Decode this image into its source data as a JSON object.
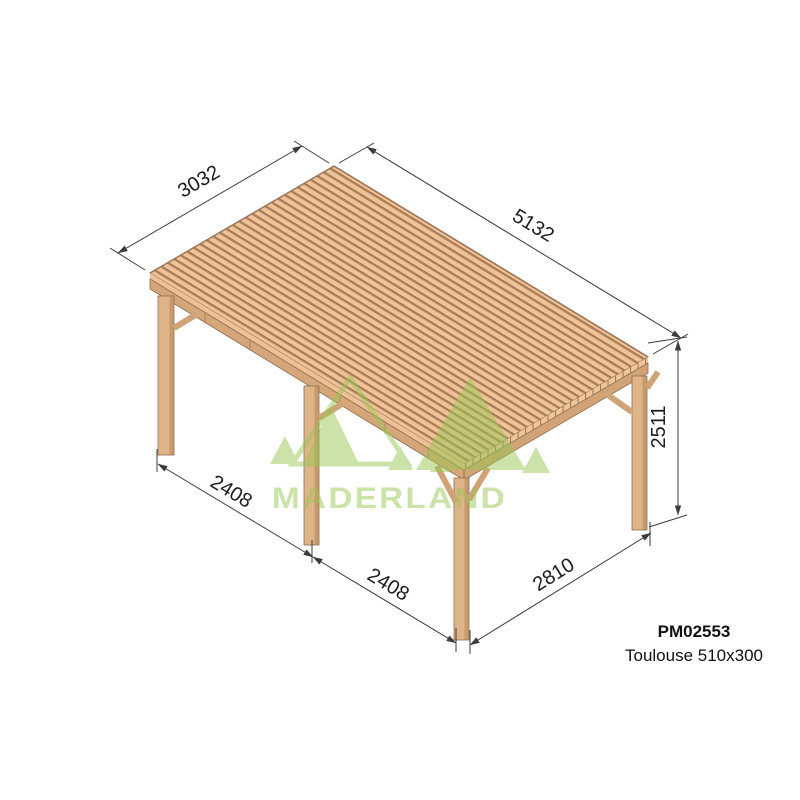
{
  "product": {
    "code": "PM02553",
    "name": "Toulouse 510x300"
  },
  "watermark": {
    "brand": "MADERLAND"
  },
  "dimensions": {
    "roof_depth": "3032",
    "roof_width": "5132",
    "post_height": "2511",
    "bay_left_1": "2408",
    "bay_left_2": "2408",
    "bay_front": "2810"
  },
  "colors": {
    "wood_slat": "#f0c298",
    "wood_gap": "#b3875f",
    "wood_beam": "#d5a679",
    "wood_post": "#e0b489",
    "wood_outline": "#8d6d50",
    "watermark_green": "#98c653",
    "dimension_line": "#3c3c3c",
    "text": "#1c1c1c",
    "background": "#ffffff"
  }
}
